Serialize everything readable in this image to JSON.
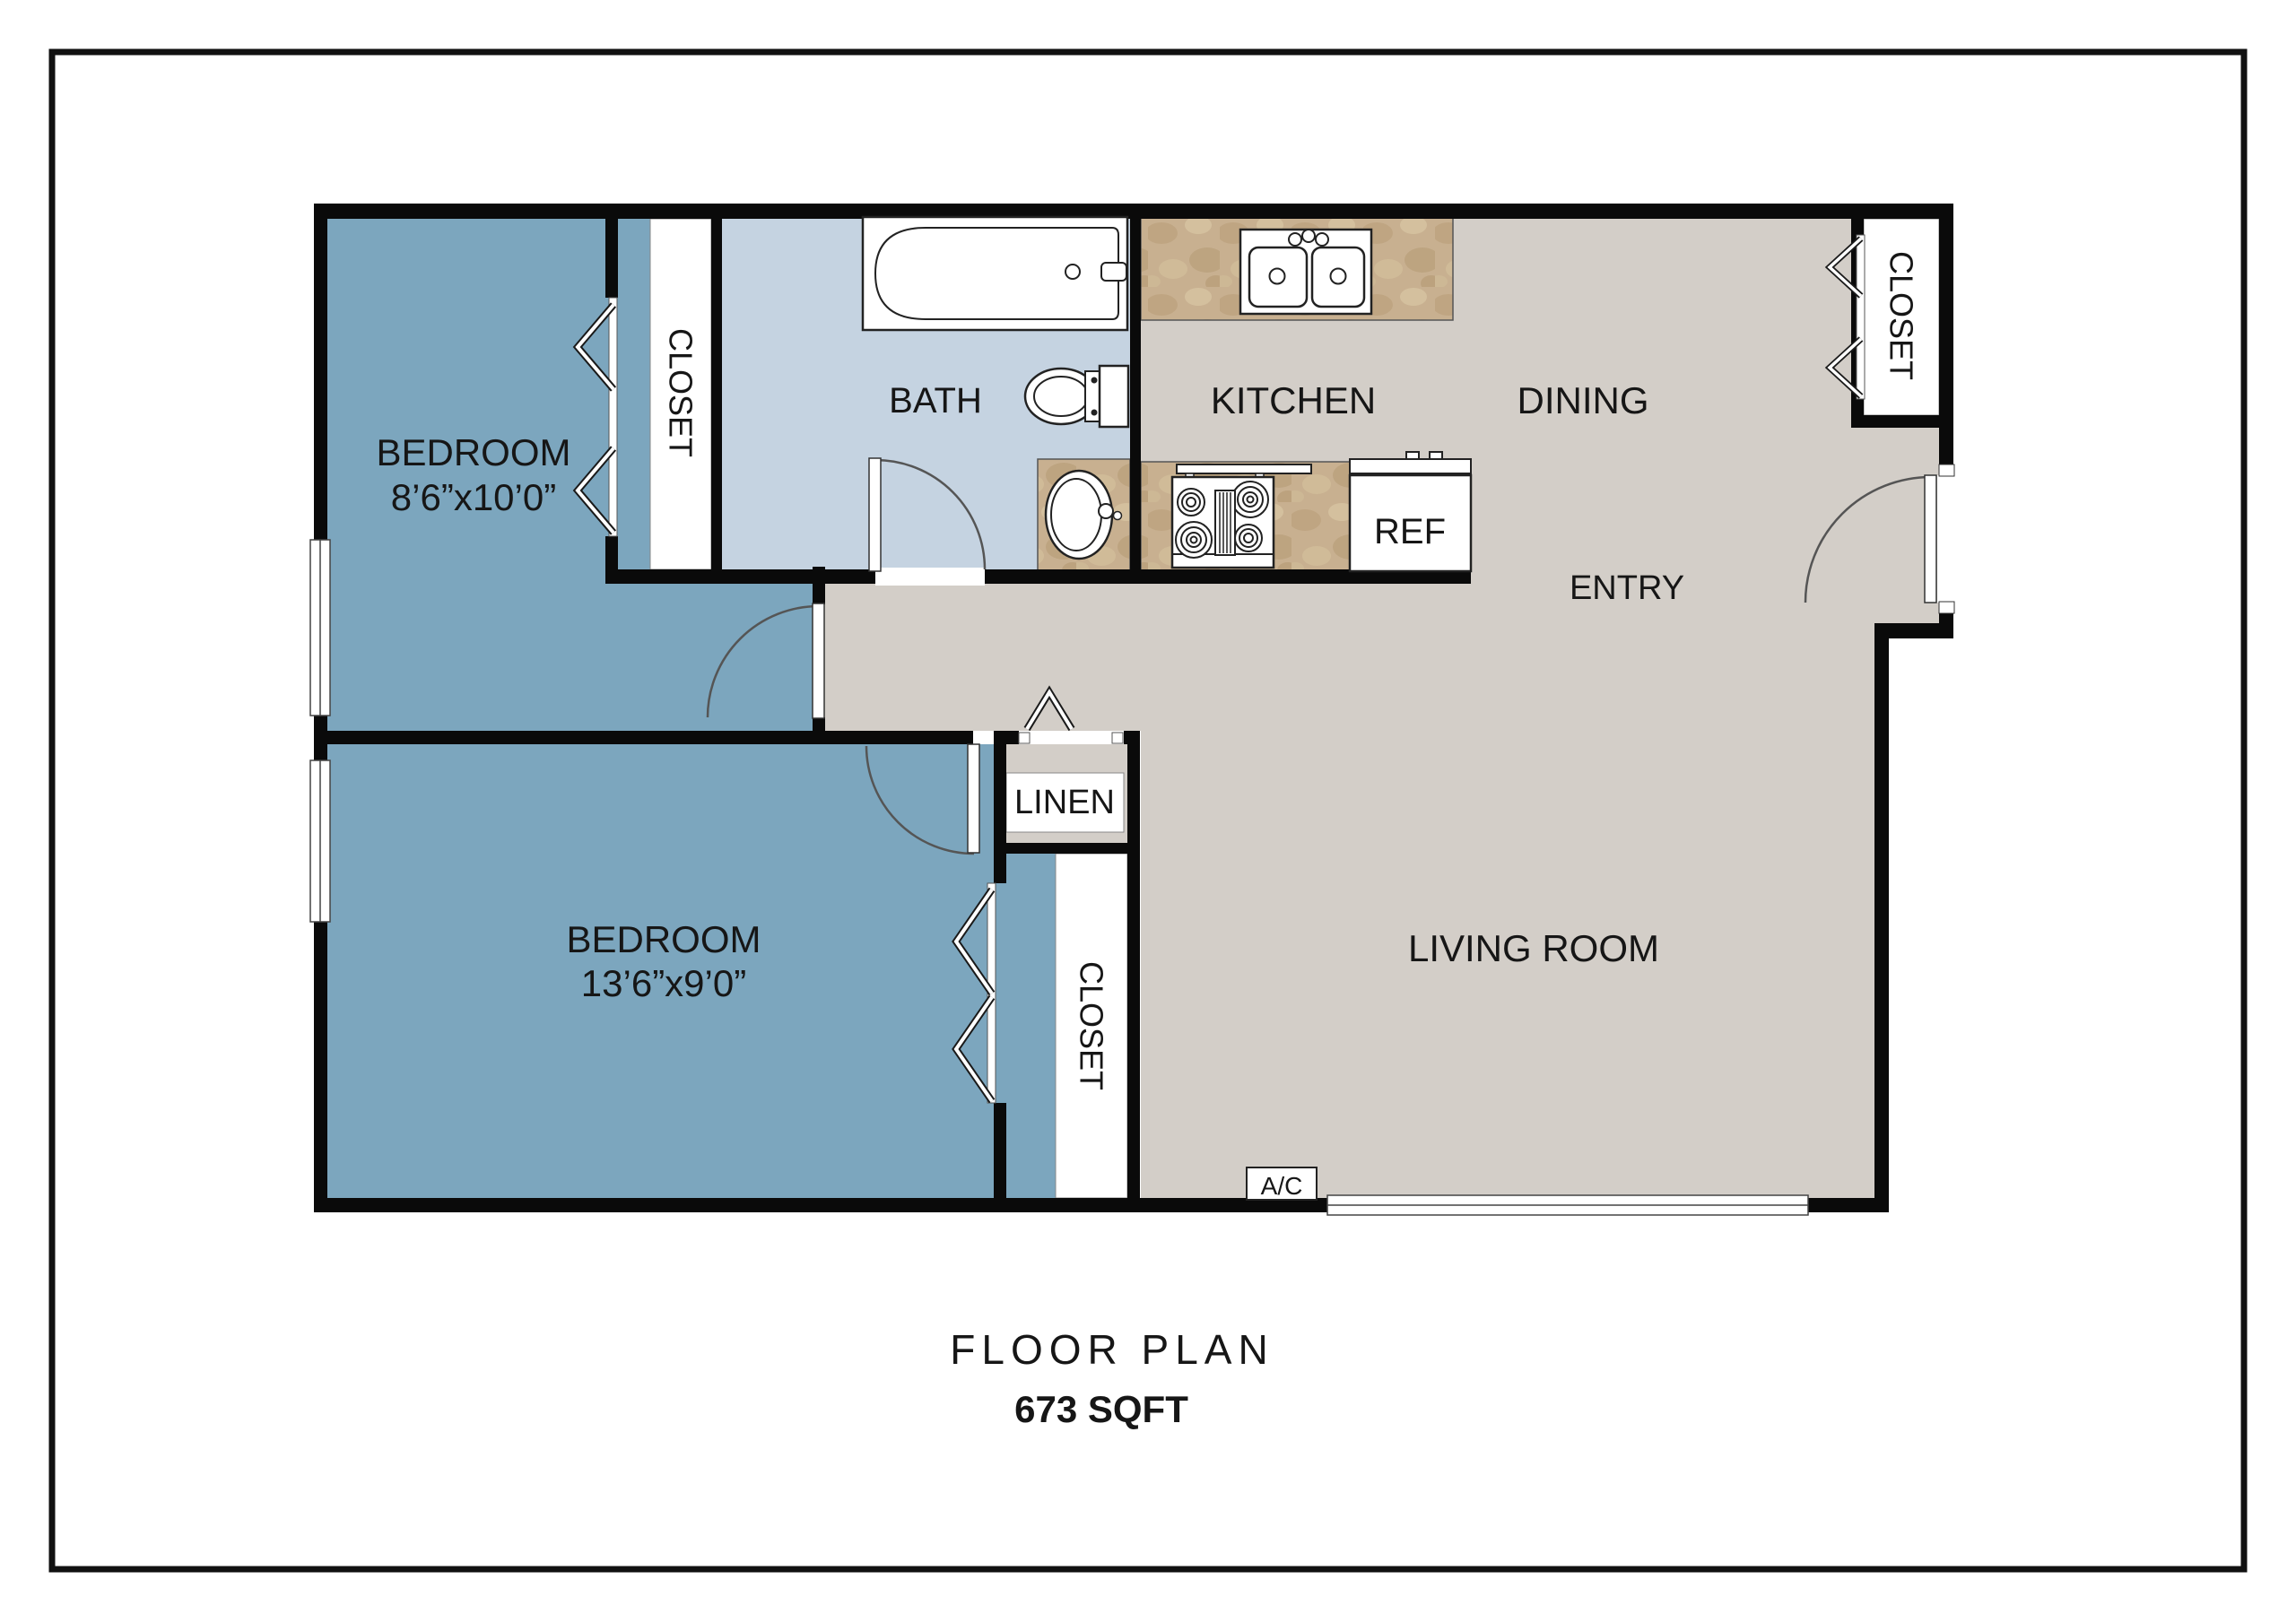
{
  "title": {
    "main": "FLOOR PLAN",
    "sqft": "673 SQFT"
  },
  "labels": {
    "bedroom1_name": "BEDROOM",
    "bedroom1_dims": "8’6”x10’0”",
    "bedroom2_name": "BEDROOM",
    "bedroom2_dims": "13’6”x9’0”",
    "bath": "BATH",
    "kitchen": "KITCHEN",
    "dining": "DINING",
    "entry": "ENTRY",
    "living_room": "LIVING ROOM",
    "linen": "LINEN",
    "closet_bedroom1": "CLOSET",
    "closet_bedroom2": "CLOSET",
    "closet_dining": "CLOSET",
    "fridge": "REF",
    "ac_unit": "A/C"
  },
  "colors": {
    "bedroom_floor": "#7CA6BE",
    "bath_floor": "#C5D3E1",
    "common_floor": "#D3CEC8",
    "counter_tan": "#C8B090",
    "wall": "#0A0A0A",
    "frame": "#111111",
    "fixture_stroke": "#222222"
  }
}
